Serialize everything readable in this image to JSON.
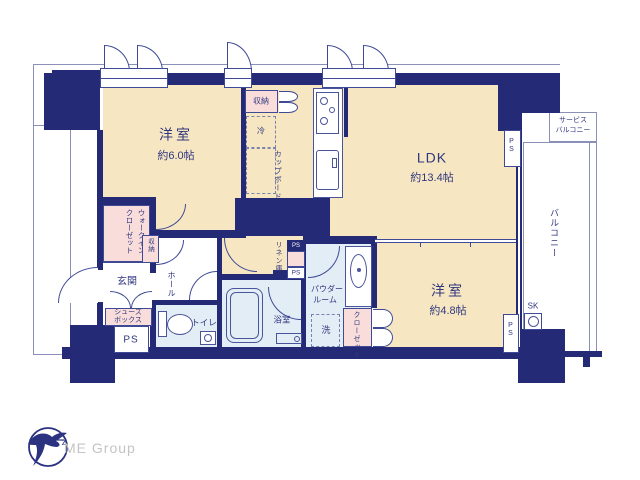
{
  "colors": {
    "wall": "#252a76",
    "floor": "#f6e7c2",
    "closet_pink": "#f9dddb",
    "wet_blue": "#e3edf5",
    "fixture_line": "#3f4a96",
    "outline": "#8b90b8",
    "text": "#31377f",
    "logo_gray": "#c4c4c4"
  },
  "rooms": {
    "bedroom1": {
      "name": "洋室",
      "size": "約6.0帖"
    },
    "ldk": {
      "name": "LDK",
      "size": "約13.4帖"
    },
    "bedroom2": {
      "name": "洋室",
      "size": "約4.8帖"
    },
    "entrance": "玄関",
    "hall": "ホール",
    "toilet": "トイレ",
    "bathroom": "浴室",
    "powder_room": {
      "line1": "パウダー",
      "line2": "ルーム"
    },
    "washer": "洗"
  },
  "storage": {
    "wic": {
      "line1": "ウォークイン",
      "line2": "クローゼット"
    },
    "hall_storage": "収納",
    "kitchen_storage": "収納",
    "fridge": "冷",
    "cupboard": "カップボード",
    "linen": "リネン庫",
    "closet": "クローゼット",
    "shoe_box": {
      "line1": "シューズ",
      "line2": "ボックス"
    }
  },
  "outdoor": {
    "balcony": "バルコニー",
    "service_balcony": {
      "line1": "サービス",
      "line2": "バルコニー"
    },
    "sk": "SK"
  },
  "labels": {
    "ps_entrance": "PS",
    "ps_top_right": "PS",
    "ps_bottom_right": "PS",
    "ps_linen_top": "PS",
    "ps_linen_bottom": "PS"
  },
  "footer": {
    "brand": "ME Group"
  }
}
